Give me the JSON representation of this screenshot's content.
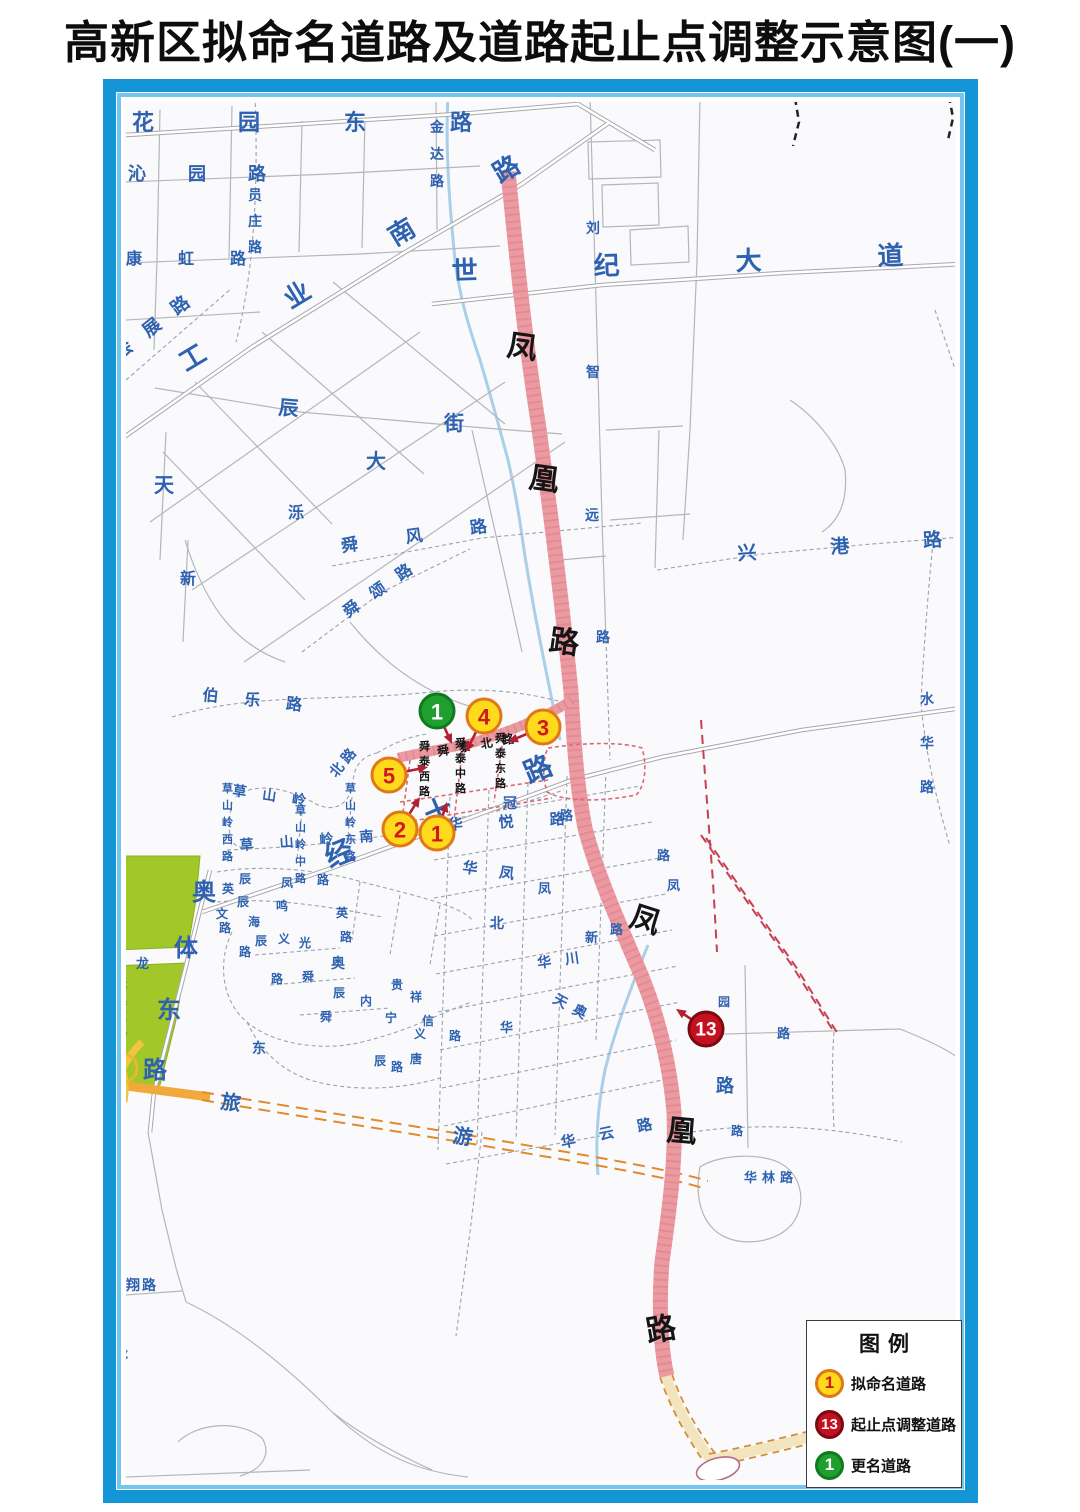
{
  "title": "高新区拟命名道路及道路起止点调整示意图(一)",
  "legend": {
    "title": "图例",
    "items": [
      {
        "symbol": "1",
        "kind": "yellow",
        "label": "拟命名道路"
      },
      {
        "symbol": "13",
        "kind": "red",
        "label": "起止点调整道路"
      },
      {
        "symbol": "1",
        "kind": "green",
        "label": "更名道路"
      }
    ]
  },
  "colors": {
    "label_blue": "#2e62b0",
    "label_black": "#151515",
    "pink_road": "#ec9aa2",
    "park_green": "#a2c728",
    "river_blue": "#a9cfe9",
    "arrow": "#b02030",
    "marker_styles": {
      "yellow": {
        "fill": "#ffd91c",
        "stroke": "#e07818",
        "num": "#d01818"
      },
      "red": {
        "fill": "#c5101f",
        "stroke": "#7a0a12",
        "num": "#ffffff"
      },
      "green": {
        "fill": "#1fa02e",
        "stroke": "#0f7a1e",
        "num": "#ffffff"
      }
    }
  },
  "map": {
    "markers": [
      {
        "n": "1",
        "kind": "green",
        "x": 437,
        "y": 711,
        "ax": 452,
        "ay": 744
      },
      {
        "n": "4",
        "kind": "yellow",
        "x": 484,
        "y": 716,
        "ax": 466,
        "ay": 752
      },
      {
        "n": "3",
        "kind": "yellow",
        "x": 543,
        "y": 727,
        "ax": 508,
        "ay": 742
      },
      {
        "n": "5",
        "kind": "yellow",
        "x": 389,
        "y": 775,
        "ax": 428,
        "ay": 767
      },
      {
        "n": "2",
        "kind": "yellow",
        "x": 400,
        "y": 829,
        "ax": 420,
        "ay": 797
      },
      {
        "n": "1",
        "kind": "yellow",
        "x": 437,
        "y": 833,
        "ax": 447,
        "ay": 802
      },
      {
        "n": "13",
        "kind": "red",
        "x": 706,
        "y": 1029,
        "ax": 676,
        "ay": 1009
      }
    ],
    "labels": [
      {
        "t": "花园东路",
        "x": 132,
        "y": 130,
        "s": 22,
        "ls": 84
      },
      {
        "t": "沁园路",
        "x": 128,
        "y": 180,
        "s": 18,
        "ls": 42
      },
      {
        "t": "员庄路",
        "x": 248,
        "y": 200,
        "s": 14,
        "v": 1,
        "g": 26
      },
      {
        "t": "康虹路",
        "x": 126,
        "y": 264,
        "s": 16,
        "ls": 36
      },
      {
        "t": "会展路",
        "x": 120,
        "y": 360,
        "s": 18,
        "ls": 18,
        "r": -38
      },
      {
        "t": "工业南路",
        "x": 186,
        "y": 372,
        "s": 26,
        "ls": 96,
        "r": -31
      },
      {
        "t": "金达路",
        "x": 430,
        "y": 132,
        "s": 14,
        "v": 1,
        "g": 27
      },
      {
        "t": "世纪大道",
        "x": 452,
        "y": 280,
        "s": 26,
        "ls": 116,
        "r": -2
      },
      {
        "t": "刘",
        "x": 586,
        "y": 233,
        "s": 14
      },
      {
        "t": "智",
        "x": 586,
        "y": 377,
        "s": 14
      },
      {
        "t": "远",
        "x": 585,
        "y": 520,
        "s": 14
      },
      {
        "t": "路",
        "x": 596,
        "y": 642,
        "s": 14
      },
      {
        "t": "凤",
        "x": 506,
        "y": 355,
        "s": 30,
        "c": "#151515",
        "r": 8
      },
      {
        "t": "凰",
        "x": 528,
        "y": 487,
        "s": 30,
        "c": "#151515",
        "r": 8
      },
      {
        "t": "路",
        "x": 548,
        "y": 650,
        "s": 30,
        "c": "#151515",
        "r": 8
      },
      {
        "t": "凤",
        "x": 628,
        "y": 925,
        "s": 30,
        "c": "#151515",
        "r": 18
      },
      {
        "t": "凰",
        "x": 666,
        "y": 1140,
        "s": 30,
        "c": "#151515",
        "r": 5
      },
      {
        "t": "路",
        "x": 648,
        "y": 1342,
        "s": 30,
        "c": "#151515",
        "r": -10
      },
      {
        "t": "辰",
        "x": 278,
        "y": 414,
        "s": 20,
        "r": 5
      },
      {
        "t": "大",
        "x": 366,
        "y": 468,
        "s": 20
      },
      {
        "t": "街",
        "x": 444,
        "y": 430,
        "s": 20
      },
      {
        "t": "天",
        "x": 154,
        "y": 492,
        "s": 20
      },
      {
        "t": "泺",
        "x": 288,
        "y": 518,
        "s": 16
      },
      {
        "t": "新",
        "x": 180,
        "y": 584,
        "s": 16
      },
      {
        "t": "舜风路",
        "x": 342,
        "y": 552,
        "s": 17,
        "ls": 48,
        "r": -8
      },
      {
        "t": "舜颂路",
        "x": 348,
        "y": 618,
        "s": 16,
        "ls": 16,
        "r": -35
      },
      {
        "t": "伯乐路",
        "x": 202,
        "y": 700,
        "s": 16,
        "ls": 26,
        "r": 6
      },
      {
        "t": "兴港路",
        "x": 738,
        "y": 560,
        "s": 19,
        "ls": 74,
        "r": -4
      },
      {
        "t": "水华路",
        "x": 920,
        "y": 704,
        "s": 14,
        "v": 1,
        "g": 44
      },
      {
        "t": "草山岭",
        "x": 232,
        "y": 795,
        "s": 14,
        "ls": 16,
        "r": 8
      },
      {
        "t": "北路",
        "x": 336,
        "y": 778,
        "s": 14,
        "ls": 4,
        "r": -50
      },
      {
        "t": "草山岭西路",
        "x": 222,
        "y": 792,
        "s": 11,
        "v": 1,
        "g": 17
      },
      {
        "t": "草山岭中路",
        "x": 295,
        "y": 814,
        "s": 11,
        "v": 1,
        "g": 17
      },
      {
        "t": "草山岭东路",
        "x": 345,
        "y": 792,
        "s": 11,
        "v": 1,
        "g": 17
      },
      {
        "t": "草山岭南路",
        "x": 240,
        "y": 850,
        "s": 14,
        "ls": 26,
        "r": -4
      },
      {
        "t": "经十路",
        "x": 330,
        "y": 868,
        "s": 28,
        "ls": 80,
        "r": -23
      },
      {
        "t": "奥",
        "x": 192,
        "y": 900,
        "s": 24
      },
      {
        "t": "体",
        "x": 174,
        "y": 956,
        "s": 24
      },
      {
        "t": "东",
        "x": 157,
        "y": 1018,
        "s": 24
      },
      {
        "t": "路",
        "x": 143,
        "y": 1078,
        "s": 24
      },
      {
        "t": "龙",
        "x": 136,
        "y": 968,
        "s": 13
      },
      {
        "t": "龙奥东路",
        "x": 117,
        "y": 988,
        "s": 10,
        "v": 1,
        "g": 16
      },
      {
        "t": "旅",
        "x": 220,
        "y": 1108,
        "s": 20,
        "r": 8
      },
      {
        "t": "游",
        "x": 452,
        "y": 1142,
        "s": 20,
        "r": 8
      },
      {
        "t": "华悦路",
        "x": 448,
        "y": 830,
        "s": 15,
        "ls": 36,
        "r": -3
      },
      {
        "t": "华凤",
        "x": 462,
        "y": 872,
        "s": 15,
        "ls": 22,
        "r": 8
      },
      {
        "t": "路",
        "x": 560,
        "y": 820,
        "s": 13
      },
      {
        "t": "凤",
        "x": 538,
        "y": 893,
        "s": 13
      },
      {
        "t": "北",
        "x": 490,
        "y": 928,
        "s": 14
      },
      {
        "t": "华川",
        "x": 538,
        "y": 968,
        "s": 14,
        "ls": 14,
        "r": -8
      },
      {
        "t": "新",
        "x": 585,
        "y": 942,
        "s": 13
      },
      {
        "t": "路",
        "x": 610,
        "y": 934,
        "s": 13
      },
      {
        "t": "天奥",
        "x": 552,
        "y": 1002,
        "s": 14,
        "ls": 8,
        "r": 28
      },
      {
        "t": "华",
        "x": 500,
        "y": 1032,
        "s": 13
      },
      {
        "t": "华云路",
        "x": 562,
        "y": 1148,
        "s": 15,
        "ls": 24,
        "r": -12
      },
      {
        "t": "华林路",
        "x": 744,
        "y": 1182,
        "s": 13,
        "ls": 5
      },
      {
        "t": "龙翔路",
        "x": 110,
        "y": 1290,
        "s": 14,
        "ls": 2
      },
      {
        "t": "龙",
        "x": 112,
        "y": 1142,
        "s": 12
      },
      {
        "t": "龙",
        "x": 116,
        "y": 1358,
        "s": 12
      },
      {
        "t": "舜泰北路",
        "x": 438,
        "y": 756,
        "s": 12,
        "ls": 10,
        "r": -10,
        "c": "#151515"
      },
      {
        "t": "舜泰西路",
        "x": 419,
        "y": 750,
        "s": 11,
        "v": 1,
        "g": 15,
        "c": "#151515"
      },
      {
        "t": "舜泰中路",
        "x": 455,
        "y": 747,
        "s": 11,
        "v": 1,
        "g": 15,
        "c": "#151515"
      },
      {
        "t": "舜泰东路",
        "x": 495,
        "y": 742,
        "s": 11,
        "v": 1,
        "g": 15,
        "c": "#151515"
      },
      {
        "t": "冠",
        "x": 503,
        "y": 808,
        "s": 14
      },
      {
        "t": "辰",
        "x": 239,
        "y": 883,
        "s": 12
      },
      {
        "t": "凤",
        "x": 281,
        "y": 887,
        "s": 12
      },
      {
        "t": "路",
        "x": 317,
        "y": 884,
        "s": 12
      },
      {
        "t": "英",
        "x": 222,
        "y": 893,
        "s": 12
      },
      {
        "t": "辰",
        "x": 237,
        "y": 906,
        "s": 12
      },
      {
        "t": "鸣",
        "x": 276,
        "y": 910,
        "s": 12
      },
      {
        "t": "海",
        "x": 248,
        "y": 926,
        "s": 12
      },
      {
        "t": "文",
        "x": 216,
        "y": 918,
        "s": 12
      },
      {
        "t": "路",
        "x": 219,
        "y": 932,
        "s": 12
      },
      {
        "t": "辰",
        "x": 255,
        "y": 945,
        "s": 12
      },
      {
        "t": "义",
        "x": 278,
        "y": 943,
        "s": 12
      },
      {
        "t": "光",
        "x": 299,
        "y": 947,
        "s": 12
      },
      {
        "t": "路",
        "x": 340,
        "y": 941,
        "s": 12
      },
      {
        "t": "英",
        "x": 336,
        "y": 917,
        "s": 12
      },
      {
        "t": "路",
        "x": 239,
        "y": 956,
        "s": 12
      },
      {
        "t": "奥",
        "x": 331,
        "y": 968,
        "s": 14
      },
      {
        "t": "路",
        "x": 271,
        "y": 983,
        "s": 12
      },
      {
        "t": "舜",
        "x": 302,
        "y": 981,
        "s": 12
      },
      {
        "t": "辰",
        "x": 333,
        "y": 997,
        "s": 12
      },
      {
        "t": "贵",
        "x": 391,
        "y": 989,
        "s": 12
      },
      {
        "t": "祥",
        "x": 410,
        "y": 1001,
        "s": 12
      },
      {
        "t": "内",
        "x": 360,
        "y": 1005,
        "s": 12
      },
      {
        "t": "舜",
        "x": 320,
        "y": 1021,
        "s": 12
      },
      {
        "t": "宁",
        "x": 385,
        "y": 1022,
        "s": 12
      },
      {
        "t": "信",
        "x": 422,
        "y": 1025,
        "s": 12
      },
      {
        "t": "义",
        "x": 414,
        "y": 1038,
        "s": 12
      },
      {
        "t": "东",
        "x": 252,
        "y": 1053,
        "s": 14
      },
      {
        "t": "辰",
        "x": 374,
        "y": 1065,
        "s": 12
      },
      {
        "t": "唐",
        "x": 410,
        "y": 1063,
        "s": 12
      },
      {
        "t": "路",
        "x": 391,
        "y": 1071,
        "s": 12
      },
      {
        "t": "路",
        "x": 449,
        "y": 1040,
        "s": 12
      },
      {
        "t": "路",
        "x": 657,
        "y": 860,
        "s": 13
      },
      {
        "t": "凤",
        "x": 667,
        "y": 890,
        "s": 13
      },
      {
        "t": "园",
        "x": 718,
        "y": 1006,
        "s": 12
      },
      {
        "t": "路",
        "x": 716,
        "y": 1092,
        "s": 18
      },
      {
        "t": "路",
        "x": 777,
        "y": 1038,
        "s": 13
      },
      {
        "t": "路",
        "x": 731,
        "y": 1135,
        "s": 12
      }
    ]
  }
}
